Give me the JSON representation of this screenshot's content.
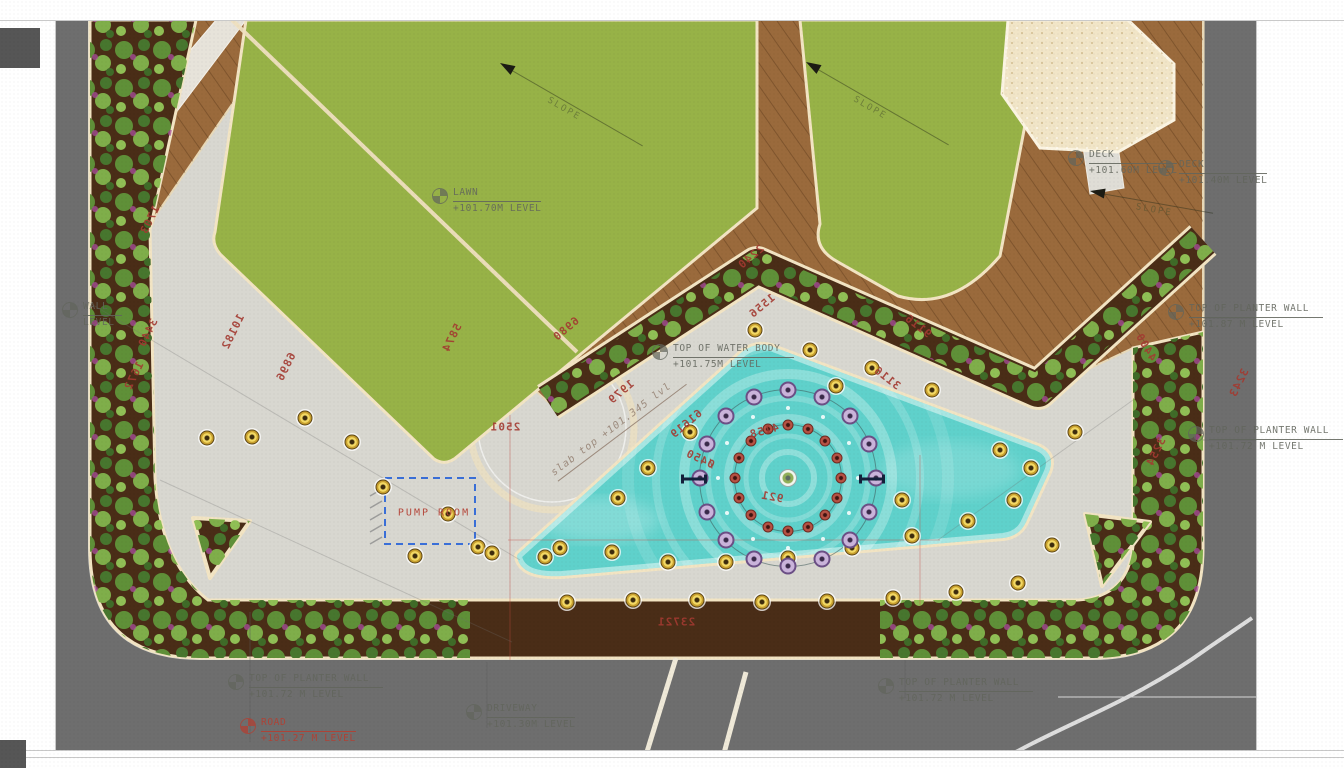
{
  "meta": {
    "type": "landscape-site-plan"
  },
  "colors": {
    "road": "#6e6e6e",
    "paving": "#d8d7d0",
    "lawn": "#97b247",
    "deck": "#9a6a3c",
    "soil": "#4a2d17",
    "curb": "#f2e4c3",
    "pool": "#5fd1cb",
    "sand": "#f1e5c7",
    "dim_red": "#a33a31",
    "label_gray": "#62655c",
    "pump_blue": "#3a6fd8",
    "light_yellow": "#f3d964",
    "jet_purple": "#8f6aae",
    "jet_red": "#a04438"
  },
  "pump_room": {
    "label": "PUMP ROOM"
  },
  "slope_label": "SLOPE",
  "labels": [
    {
      "name": "lawn-level",
      "l1": "LAWN",
      "l2": "+101.70M LEVEL",
      "x": 432,
      "y": 186,
      "icon": true
    },
    {
      "name": "water-body-level",
      "l1": "TOP OF WATER BODY",
      "l2": "+101.75M LEVEL",
      "x": 652,
      "y": 342,
      "icon": true
    },
    {
      "name": "slab-top-level",
      "l1": "slab top +101.345 lvl",
      "l2": "",
      "x": 548,
      "y": 468,
      "rot": -37,
      "cls": "slab",
      "icon": false
    },
    {
      "name": "planter-wall-level-right-upper",
      "l1": "TOP OF PLANTER WALL",
      "l2": "+101.87 M LEVEL",
      "x": 1168,
      "y": 302,
      "icon": true
    },
    {
      "name": "planter-wall-level-right-lower",
      "l1": "TOP OF PLANTER WALL",
      "l2": "+101.72 M LEVEL",
      "x": 1188,
      "y": 424,
      "icon": true
    },
    {
      "name": "planter-wall-level-bottom-left",
      "l1": "TOP OF PLANTER WALL",
      "l2": "+101.72 M LEVEL",
      "x": 228,
      "y": 672,
      "icon": true
    },
    {
      "name": "road-level",
      "l1": "ROAD",
      "l2": "+101.27 M LEVEL",
      "x": 240,
      "y": 716,
      "icon": true,
      "cls": "red"
    },
    {
      "name": "driveway-level",
      "l1": "DRIVEWAY",
      "l2": "+101.30M LEVEL",
      "x": 466,
      "y": 702,
      "icon": true
    },
    {
      "name": "planter-wall-level-bottom-right",
      "l1": "TOP OF PLANTER WALL",
      "l2": "+101.72 M LEVEL",
      "x": 878,
      "y": 676,
      "icon": true
    },
    {
      "name": "deck-level-left",
      "l1": "DECK",
      "l2": "+101.60M LEVEL",
      "x": 1068,
      "y": 148,
      "icon": true
    },
    {
      "name": "deck-level-right",
      "l1": "DECK",
      "l2": "+101.40M LEVEL",
      "x": 1158,
      "y": 158,
      "icon": true
    },
    {
      "name": "planter-wall-level-top-left-partial",
      "l1": "WALL",
      "l2": "LEVEL",
      "x": 62,
      "y": 300,
      "icon": true
    }
  ],
  "dimensions": [
    [
      "1703",
      150,
      220,
      -64
    ],
    [
      "3440",
      148,
      333,
      -64
    ],
    [
      "1672",
      134,
      376,
      -64
    ],
    [
      "10182",
      233,
      332,
      -64
    ],
    [
      "6896",
      286,
      367,
      -64
    ],
    [
      "5874",
      452,
      338,
      -64
    ],
    [
      "2501",
      505,
      427,
      0
    ],
    [
      "6980",
      566,
      329,
      -40
    ],
    [
      "1979",
      621,
      392,
      -40
    ],
    [
      "2240",
      751,
      257,
      -40
    ],
    [
      "1556",
      762,
      306,
      -40
    ],
    [
      "9116",
      918,
      326,
      38
    ],
    [
      "3116",
      887,
      378,
      38
    ],
    [
      "4400",
      1146,
      347,
      60
    ],
    [
      "3243",
      1239,
      383,
      -64
    ],
    [
      "3254",
      1156,
      452,
      -64
    ],
    [
      "23721",
      676,
      622,
      0
    ],
    [
      "4158",
      764,
      431,
      -15
    ],
    [
      "Ø450",
      700,
      459,
      25
    ],
    [
      "921",
      772,
      497,
      10
    ],
    [
      "61619",
      686,
      424,
      -40
    ]
  ],
  "lights": [
    [
      207,
      438
    ],
    [
      252,
      437
    ],
    [
      305,
      418
    ],
    [
      352,
      442
    ],
    [
      383,
      487
    ],
    [
      448,
      514
    ],
    [
      478,
      547
    ],
    [
      415,
      556
    ],
    [
      492,
      553
    ],
    [
      545,
      557
    ],
    [
      567,
      602
    ],
    [
      633,
      600
    ],
    [
      697,
      600
    ],
    [
      762,
      602
    ],
    [
      827,
      601
    ],
    [
      893,
      598
    ],
    [
      956,
      592
    ],
    [
      1018,
      583
    ],
    [
      560,
      548
    ],
    [
      612,
      552
    ],
    [
      668,
      562
    ],
    [
      726,
      562
    ],
    [
      788,
      558
    ],
    [
      852,
      548
    ],
    [
      912,
      536
    ],
    [
      968,
      521
    ],
    [
      1014,
      500
    ],
    [
      1031,
      468
    ],
    [
      690,
      432
    ],
    [
      648,
      468
    ],
    [
      618,
      498
    ],
    [
      755,
      330
    ],
    [
      810,
      350
    ],
    [
      872,
      368
    ],
    [
      932,
      390
    ],
    [
      1000,
      450
    ],
    [
      1052,
      545
    ],
    [
      1075,
      432
    ],
    [
      902,
      500
    ],
    [
      836,
      386
    ]
  ],
  "fountain": {
    "cx": 788,
    "cy": 478,
    "outer_r": 88,
    "outer_count": 16,
    "inner_r": 53,
    "inner_count": 16,
    "mini_r": 70,
    "mini_count": 12
  },
  "slope_arrows": [
    {
      "x": 500,
      "y": 58,
      "angle": 30,
      "len": 150
    },
    {
      "x": 806,
      "y": 57,
      "angle": 30,
      "len": 150
    },
    {
      "x": 1090,
      "y": 186,
      "angle": 10,
      "len": 110
    }
  ],
  "section_markers": [
    [
      694,
      479
    ],
    [
      872,
      479
    ]
  ]
}
